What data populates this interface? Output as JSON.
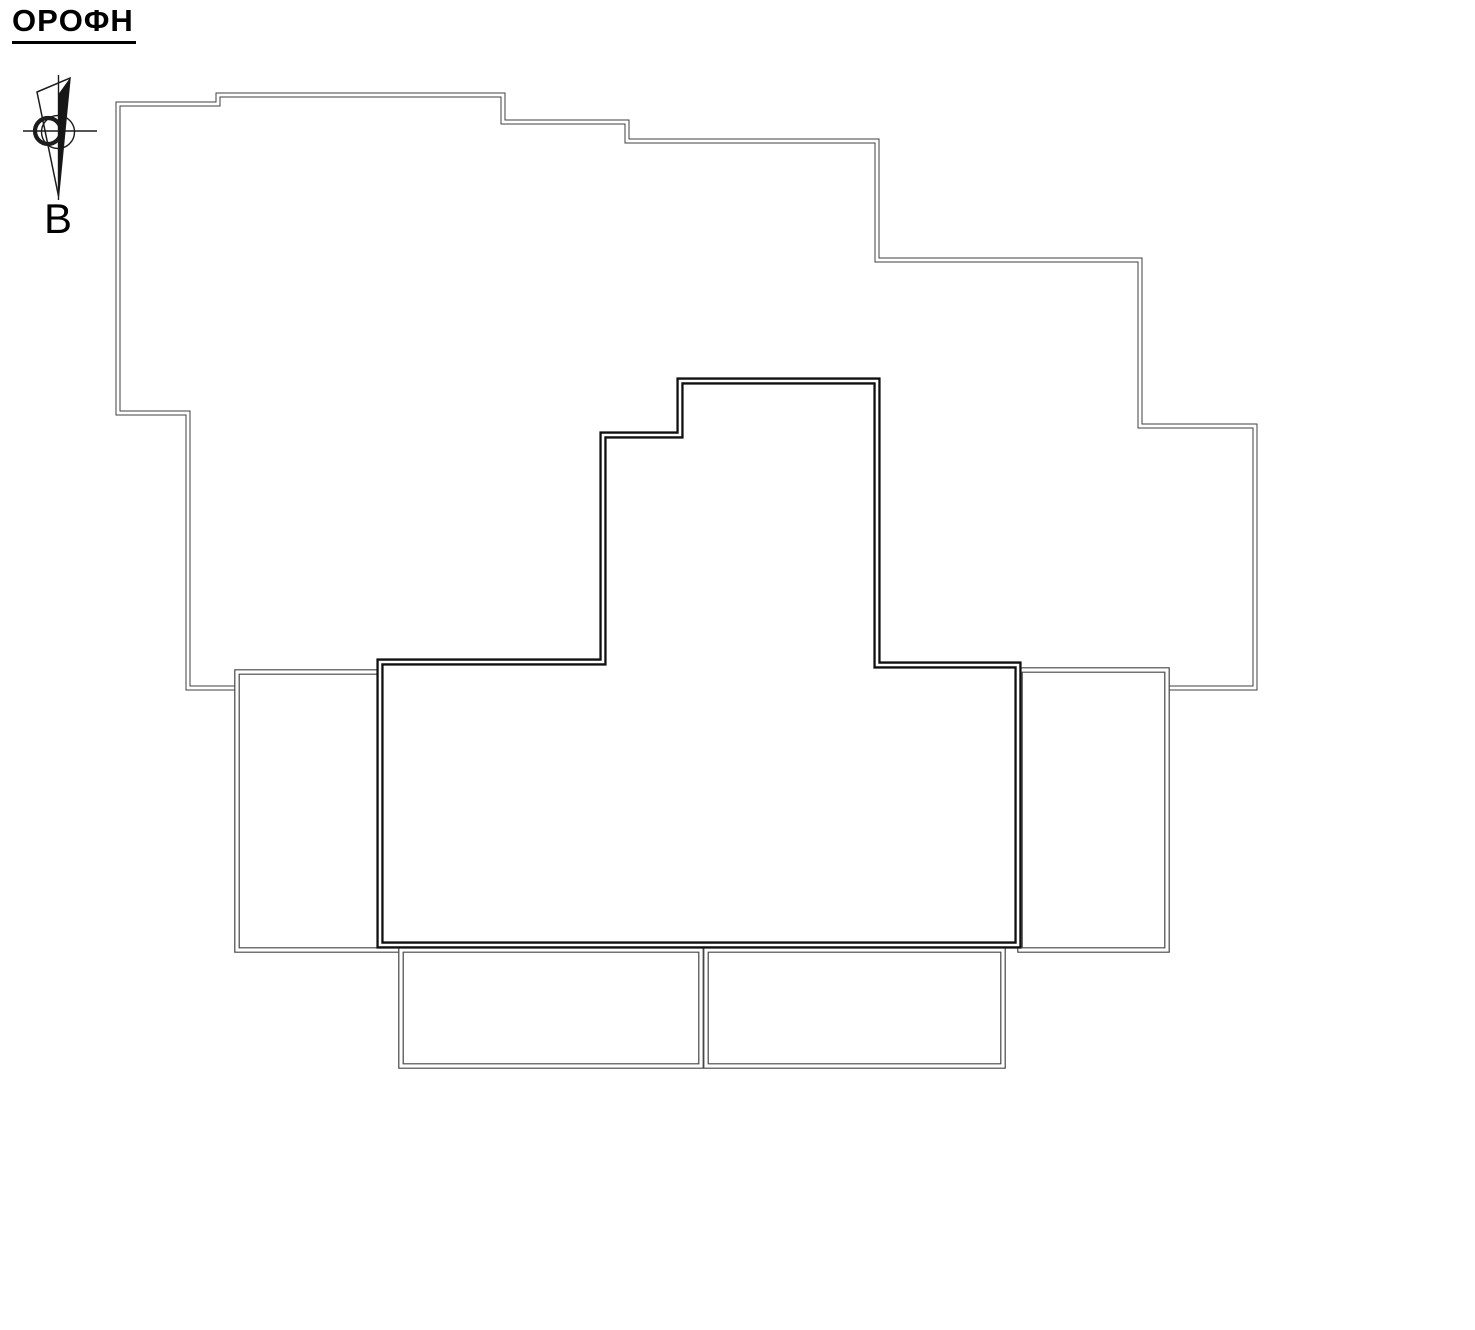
{
  "header": {
    "title": "ΟΡΟΦΗ"
  },
  "compass": {
    "north_label": "B",
    "icon": "north-arrow-compass"
  },
  "canvas": {
    "background": "#ffffff",
    "line_color_light": "#3f3f3f",
    "line_color_medium": "#464646",
    "line_color_heavy": "#101010"
  }
}
